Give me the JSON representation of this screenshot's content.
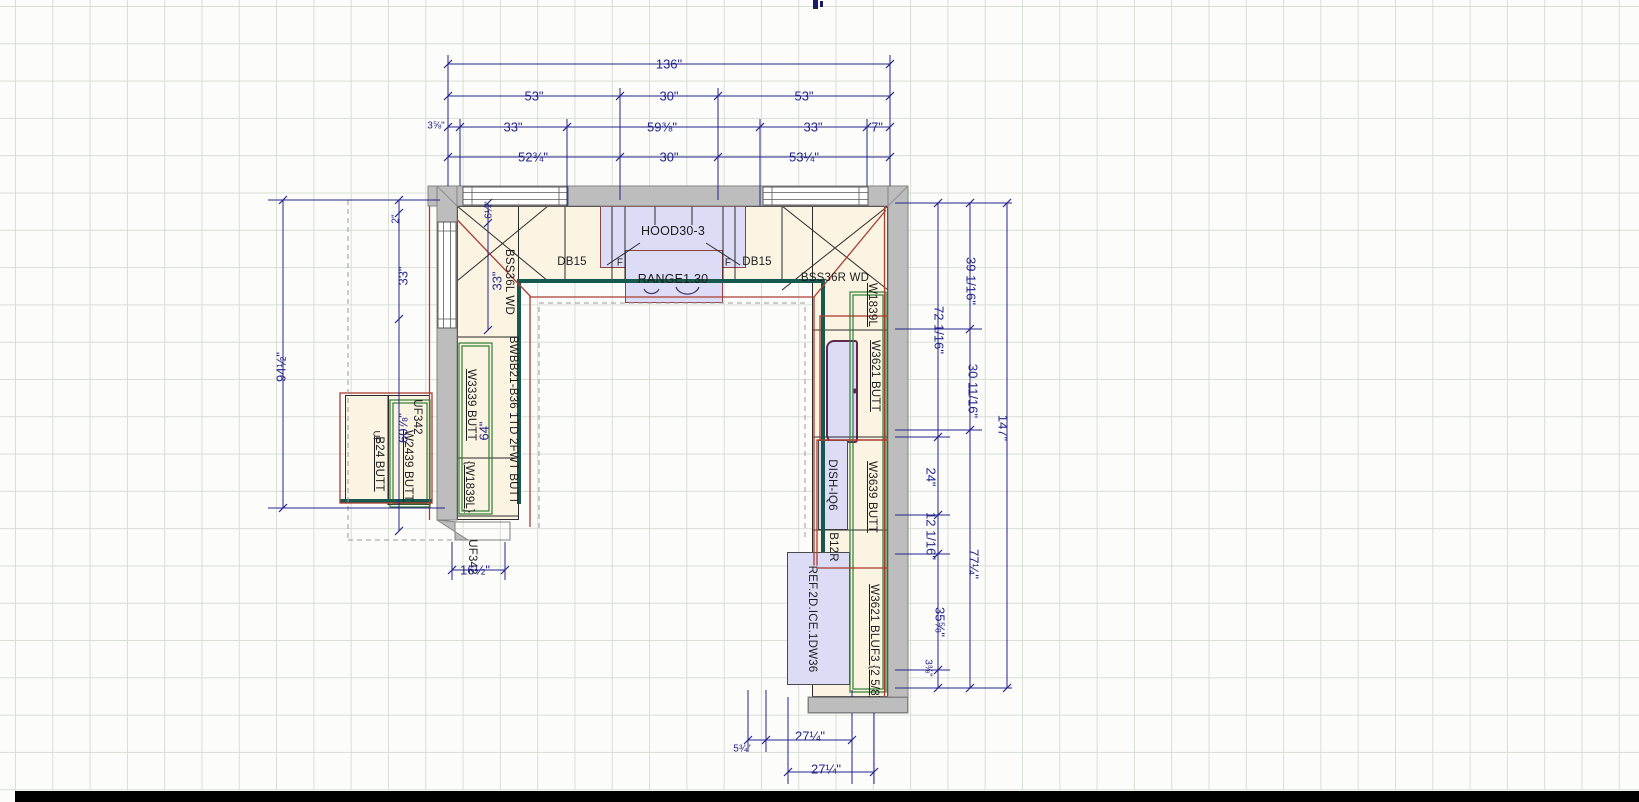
{
  "app": {
    "type": "kitchen-design-cad-floor-plan"
  },
  "colors": {
    "dimension": "#24248c",
    "counter_edge": "#17594e",
    "selection": "#ab3c31",
    "wall_cabinet_outline": "#2f7d36",
    "wall_fill": "#bdbdbd",
    "cabinet_fill": "#fbf4e3",
    "appliance_fill": "#dcdcf6",
    "grid": "#d8dfd5"
  },
  "dims": {
    "top": {
      "total": "136\"",
      "row2": [
        "53\"",
        "30\"",
        "53\""
      ],
      "row3": [
        "3⅝\"",
        "33\"",
        "59⅜\"",
        "33\"",
        "7\""
      ],
      "row4": [
        "52¾\"",
        "30\"",
        "53¼\""
      ]
    },
    "left": {
      "overall": "94½\"",
      "top_gap": "2\"",
      "window": "33\"",
      "below_window": "60⅞\"",
      "corner_depth": "6¼\"",
      "corner_run": "33\"",
      "wall_cab_64": "64\""
    },
    "right": {
      "col_a": [
        "72 1/16\"",
        "24\"",
        "12 1/16\"",
        "35⅝\"",
        "3⅜\""
      ],
      "col_b": [
        "39 1/16\"",
        "30 11/16\"",
        "77¼\""
      ],
      "overall": "147\""
    },
    "bottom": {
      "offset": "5¾\"",
      "ref_width": "27¼\"",
      "ref_width2": "27¼\"",
      "peninsula": "16½\""
    }
  },
  "cabinets": {
    "bss36l": "BSS36L WD",
    "db15_left": "DB15",
    "filler_left": "F",
    "filler_right": "F",
    "db15_right": "DB15",
    "bss36r": "BSS36R WD",
    "w3339": "W3339 BUTT",
    "w1839_left": "{W1839L}",
    "bwbb": "BWBB21-B36 1TD 2FWT BUTT",
    "uf": "UF",
    "b24": "B24 BUTT",
    "w2439": "W2439 BUTT",
    "uf342_a": "UF342",
    "uf342_b": "UF342",
    "w1839_right": "W1839L",
    "w3621": "W3621 BUTT",
    "w3639": "W3639 BUTT",
    "b12r": "B12R",
    "w3621_bluf3": "W3621 BLUF3 {2 5/8}"
  },
  "appliances": {
    "hood": "HOOD30-3",
    "range": "RANGE1.30",
    "dishwasher": "DISH-IQ6",
    "refrigerator": "REF.2D.ICE.1DW36"
  }
}
